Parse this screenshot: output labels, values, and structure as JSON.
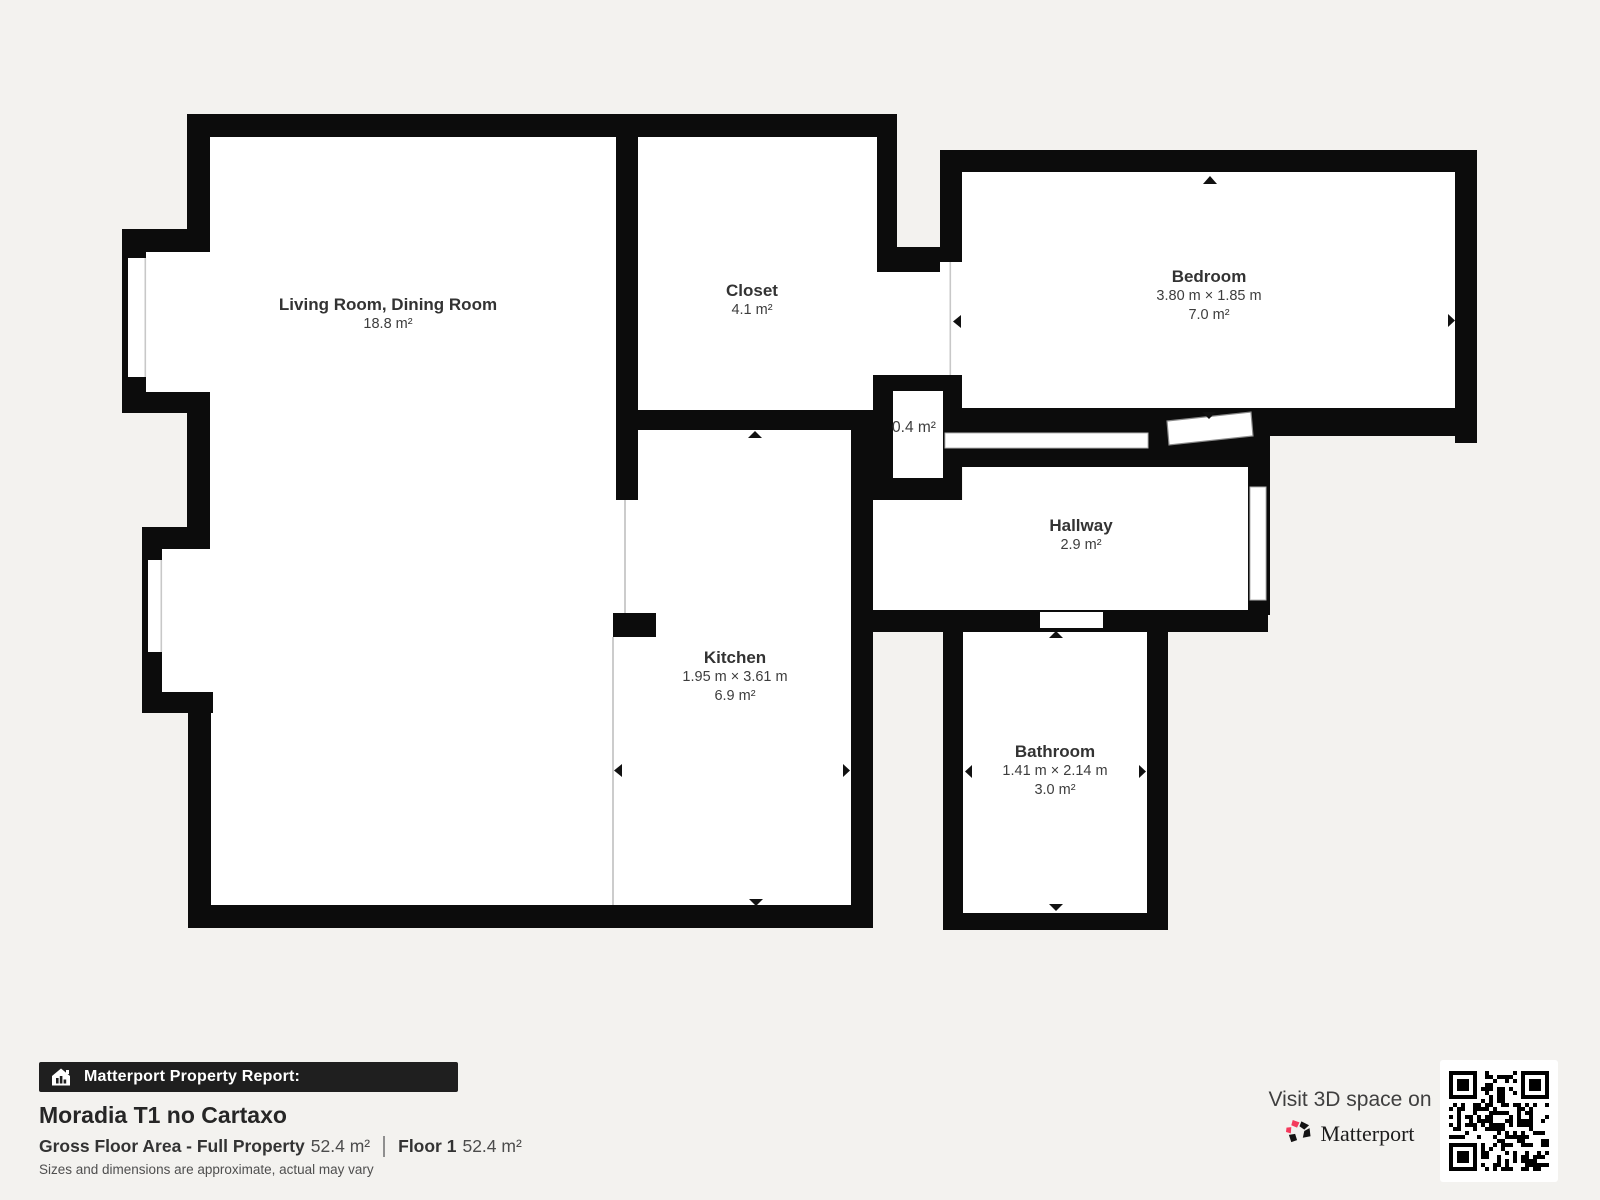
{
  "plan": {
    "rooms": [
      {
        "name": "Living Room, Dining Room",
        "dims": "",
        "area": "18.8 m²"
      },
      {
        "name": "Closet",
        "dims": "",
        "area": "4.1 m²"
      },
      {
        "name": "Bedroom",
        "dims": "3.80 m × 1.85 m",
        "area": "7.0 m²"
      },
      {
        "name": "Hallway",
        "dims": "",
        "area": "2.9 m²"
      },
      {
        "name": "Kitchen",
        "dims": "1.95 m × 3.61 m",
        "area": "6.9 m²"
      },
      {
        "name": "Bathroom",
        "dims": "1.41 m × 2.14 m",
        "area": "3.0 m²"
      },
      {
        "name": "",
        "dims": "",
        "area": "0.4 m²"
      }
    ]
  },
  "footer": {
    "report_bar": "Matterport Property Report:",
    "property_name": "Moradia T1 no Cartaxo",
    "gfa_label": "Gross Floor Area - Full Property",
    "gfa_value": "52.4 m²",
    "floor_label": "Floor 1",
    "floor_value": "52.4 m²",
    "disclaimer": "Sizes and dimensions are approximate, actual may vary",
    "visit_text": "Visit 3D space on",
    "brand": "Matterport"
  },
  "icons": {
    "report_bar": "house-icon",
    "brand": "matterport-logo",
    "qr": "qr-code"
  },
  "colors": {
    "wall": "#0c0c0c",
    "background": "#f3f2ef",
    "accent_pink": "#f43a5c",
    "open_boundary_line": "#cccccc"
  }
}
